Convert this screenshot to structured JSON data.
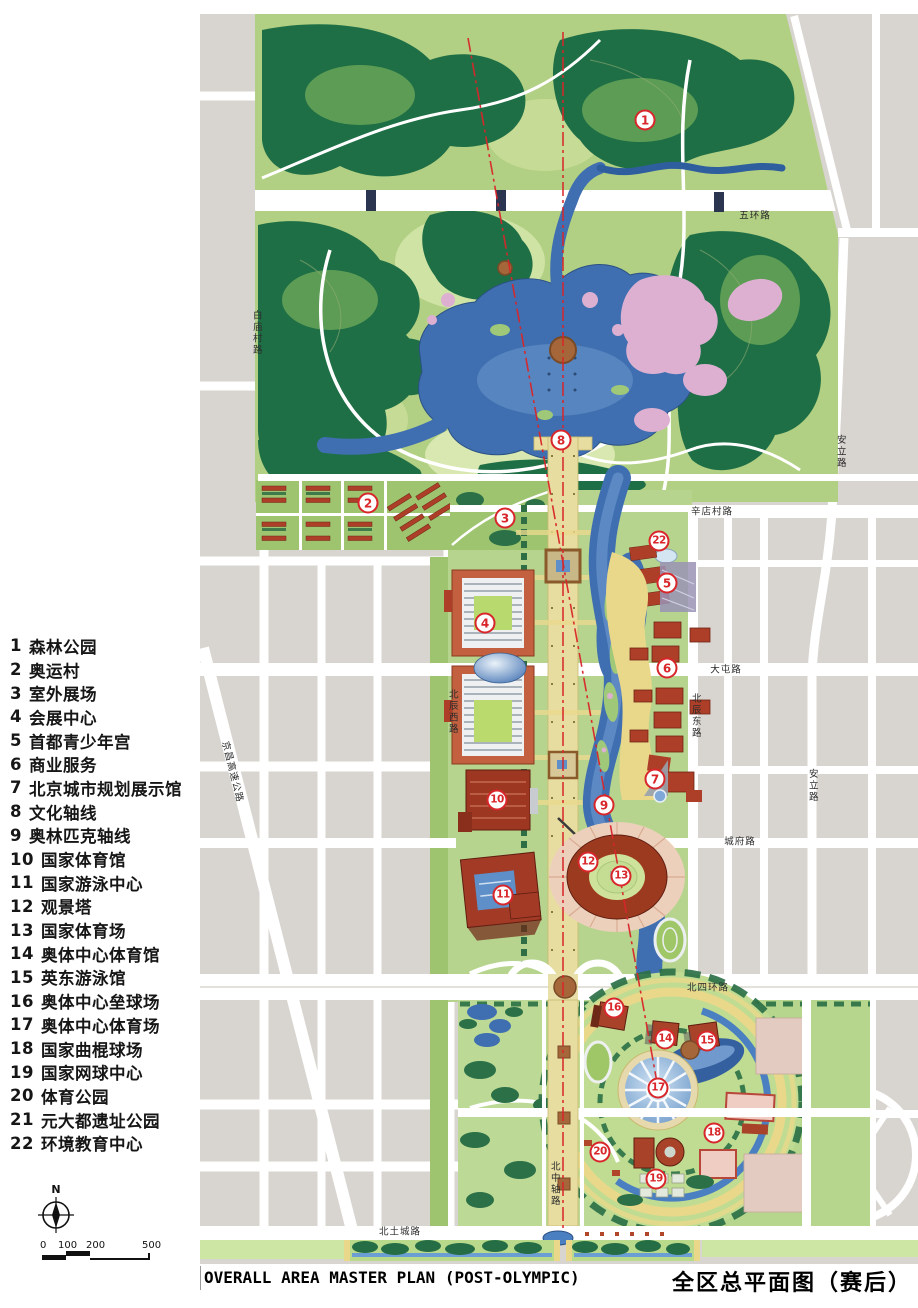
{
  "titles": {
    "en": "OVERALL AREA MASTER PLAN (POST-OLYMPIC)",
    "zh": "全区总平面图（赛后）"
  },
  "legend": {
    "items": [
      {
        "num": "1",
        "label": "森林公园"
      },
      {
        "num": "2",
        "label": "奥运村"
      },
      {
        "num": "3",
        "label": "室外展场"
      },
      {
        "num": "4",
        "label": "会展中心"
      },
      {
        "num": "5",
        "label": "首都青少年宫"
      },
      {
        "num": "6",
        "label": "商业服务"
      },
      {
        "num": "7",
        "label": "北京城市规划展示馆"
      },
      {
        "num": "8",
        "label": "文化轴线"
      },
      {
        "num": "9",
        "label": "奥林匹克轴线"
      },
      {
        "num": "10",
        "label": "国家体育馆"
      },
      {
        "num": "11",
        "label": "国家游泳中心"
      },
      {
        "num": "12",
        "label": "观景塔"
      },
      {
        "num": "13",
        "label": "国家体育场"
      },
      {
        "num": "14",
        "label": "奥体中心体育馆"
      },
      {
        "num": "15",
        "label": "英东游泳馆"
      },
      {
        "num": "16",
        "label": "奥体中心垒球场"
      },
      {
        "num": "17",
        "label": "奥体中心体育场"
      },
      {
        "num": "18",
        "label": "国家曲棍球场"
      },
      {
        "num": "19",
        "label": "国家网球中心"
      },
      {
        "num": "20",
        "label": "体育公园"
      },
      {
        "num": "21",
        "label": "元大都遗址公园"
      },
      {
        "num": "22",
        "label": "环境教育中心"
      }
    ]
  },
  "compass": {
    "north_label": "N"
  },
  "scale_bar": {
    "ticks": [
      "0",
      "100",
      "200",
      "500"
    ]
  },
  "map": {
    "markers": [
      {
        "num": "1",
        "x": 645,
        "y": 120
      },
      {
        "num": "2",
        "x": 368,
        "y": 503
      },
      {
        "num": "3",
        "x": 505,
        "y": 518
      },
      {
        "num": "4",
        "x": 485,
        "y": 623
      },
      {
        "num": "5",
        "x": 667,
        "y": 583
      },
      {
        "num": "6",
        "x": 667,
        "y": 668
      },
      {
        "num": "7",
        "x": 655,
        "y": 779
      },
      {
        "num": "8",
        "x": 561,
        "y": 440
      },
      {
        "num": "9",
        "x": 604,
        "y": 805
      },
      {
        "num": "10",
        "x": 497,
        "y": 800
      },
      {
        "num": "11",
        "x": 503,
        "y": 895
      },
      {
        "num": "12",
        "x": 588,
        "y": 862
      },
      {
        "num": "13",
        "x": 621,
        "y": 876
      },
      {
        "num": "14",
        "x": 665,
        "y": 1039
      },
      {
        "num": "15",
        "x": 707,
        "y": 1041
      },
      {
        "num": "16",
        "x": 614,
        "y": 1008
      },
      {
        "num": "17",
        "x": 658,
        "y": 1088
      },
      {
        "num": "18",
        "x": 714,
        "y": 1133
      },
      {
        "num": "19",
        "x": 656,
        "y": 1179
      },
      {
        "num": "20",
        "x": 600,
        "y": 1152
      },
      {
        "num": "22",
        "x": 659,
        "y": 541
      }
    ],
    "road_labels": [
      {
        "text": "五环路",
        "x": 755,
        "y": 216,
        "orient": "h"
      },
      {
        "text": "白庙村路",
        "x": 256,
        "y": 333,
        "orient": "v"
      },
      {
        "text": "安立路",
        "x": 840,
        "y": 452,
        "orient": "v"
      },
      {
        "text": "辛店村路",
        "x": 712,
        "y": 512,
        "orient": "h"
      },
      {
        "text": "大屯路",
        "x": 726,
        "y": 670,
        "orient": "h"
      },
      {
        "text": "北辰西路",
        "x": 452,
        "y": 712,
        "orient": "v"
      },
      {
        "text": "北辰东路",
        "x": 695,
        "y": 716,
        "orient": "v"
      },
      {
        "text": "安立路",
        "x": 812,
        "y": 786,
        "orient": "v"
      },
      {
        "text": "城府路",
        "x": 740,
        "y": 842,
        "orient": "h"
      },
      {
        "text": "北四环路",
        "x": 708,
        "y": 988,
        "orient": "h"
      },
      {
        "text": "北中轴路",
        "x": 554,
        "y": 1184,
        "orient": "v"
      },
      {
        "text": "京昌高速公路",
        "x": 232,
        "y": 772,
        "orient": "d"
      },
      {
        "text": "北土城路",
        "x": 400,
        "y": 1232,
        "orient": "h"
      }
    ]
  },
  "palette": {
    "marker_red": "#d8262a",
    "axis_red": "#d8262a",
    "city_grey": "#d8d4cf",
    "park_base": "#b2d083",
    "forest_dark": "#1f6f46",
    "water_blue": "#3f6fb0",
    "blossom_pink": "#ddb0d2",
    "axis_beige": "#e7dda0",
    "building_red": "#ad3f28",
    "path_yellow": "#e9d88a"
  }
}
